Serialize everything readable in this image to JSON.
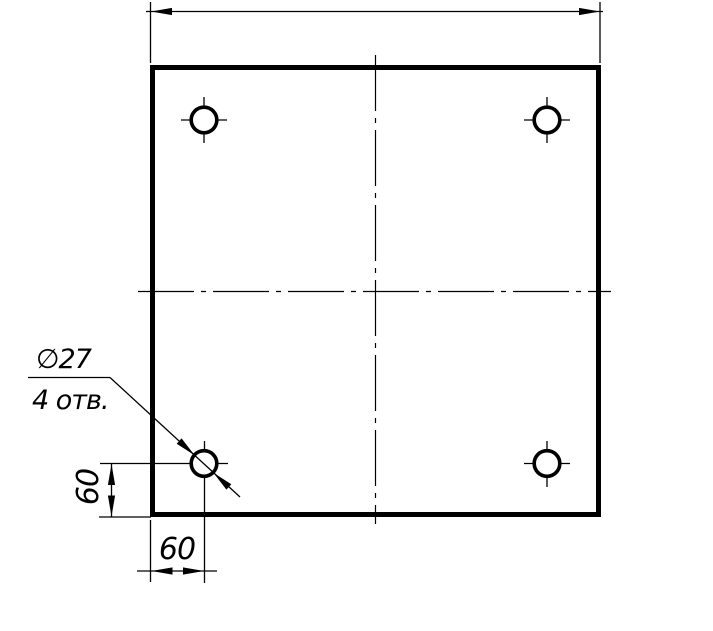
{
  "drawing": {
    "background_color": "#ffffff",
    "line_color": "#000000",
    "callout": {
      "diameter_label": "∅27",
      "count_label": "4 отв."
    },
    "dimensions": {
      "hole_offset_vertical": "60",
      "hole_offset_horizontal": "60"
    }
  }
}
